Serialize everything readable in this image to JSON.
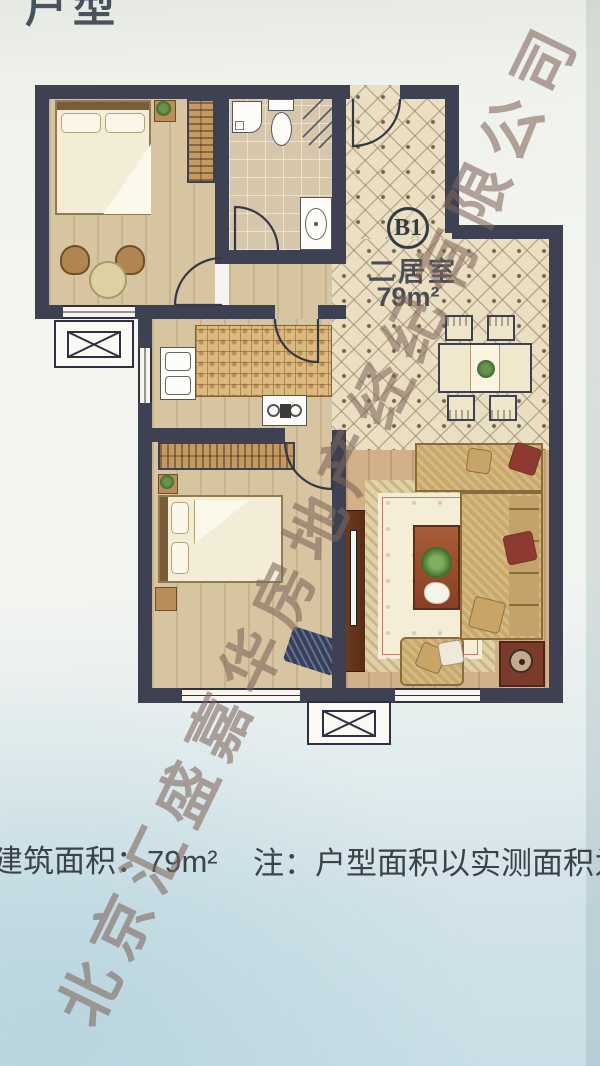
{
  "page": {
    "title": "户型",
    "watermark": "北京汇盛嘉华房地产经纪有限公司",
    "footer": {
      "area_label": "建筑面积：79m²",
      "note": "注：户型面积以实测面积为"
    }
  },
  "plan": {
    "unit_code": "B1",
    "unit_type": "二居室",
    "unit_area": "79m²",
    "furniture": [
      "double-bed",
      "wardrobe",
      "nightstand",
      "tub-chair",
      "round-table",
      "washing-machine",
      "toilet",
      "corner-shower",
      "bathroom-sink",
      "kitchen-counter",
      "kitchen-sink",
      "stove",
      "dining-table",
      "dining-chair",
      "sofa",
      "throw-pillow",
      "coffee-table",
      "potted-plant",
      "rug",
      "tv-cabinet",
      "side-table",
      "armchair",
      "ac-platform",
      "window",
      "door-arc"
    ],
    "colors": {
      "wall": "#3d4152",
      "wood_floor": "#d7c4a0",
      "tile_floor": "#ebdfc3",
      "bath_floor": "#d6c6ab",
      "counter": "#dcb97e",
      "sofa": "#c9a86c",
      "pillow_accent": "#8e3a31",
      "table_wood": "#9a4a2c",
      "text": "#3b4249",
      "watermark": "rgba(128,102,92,0.58)",
      "background_top": "#e6e9e2",
      "background_bottom": "#c9dee6"
    }
  }
}
